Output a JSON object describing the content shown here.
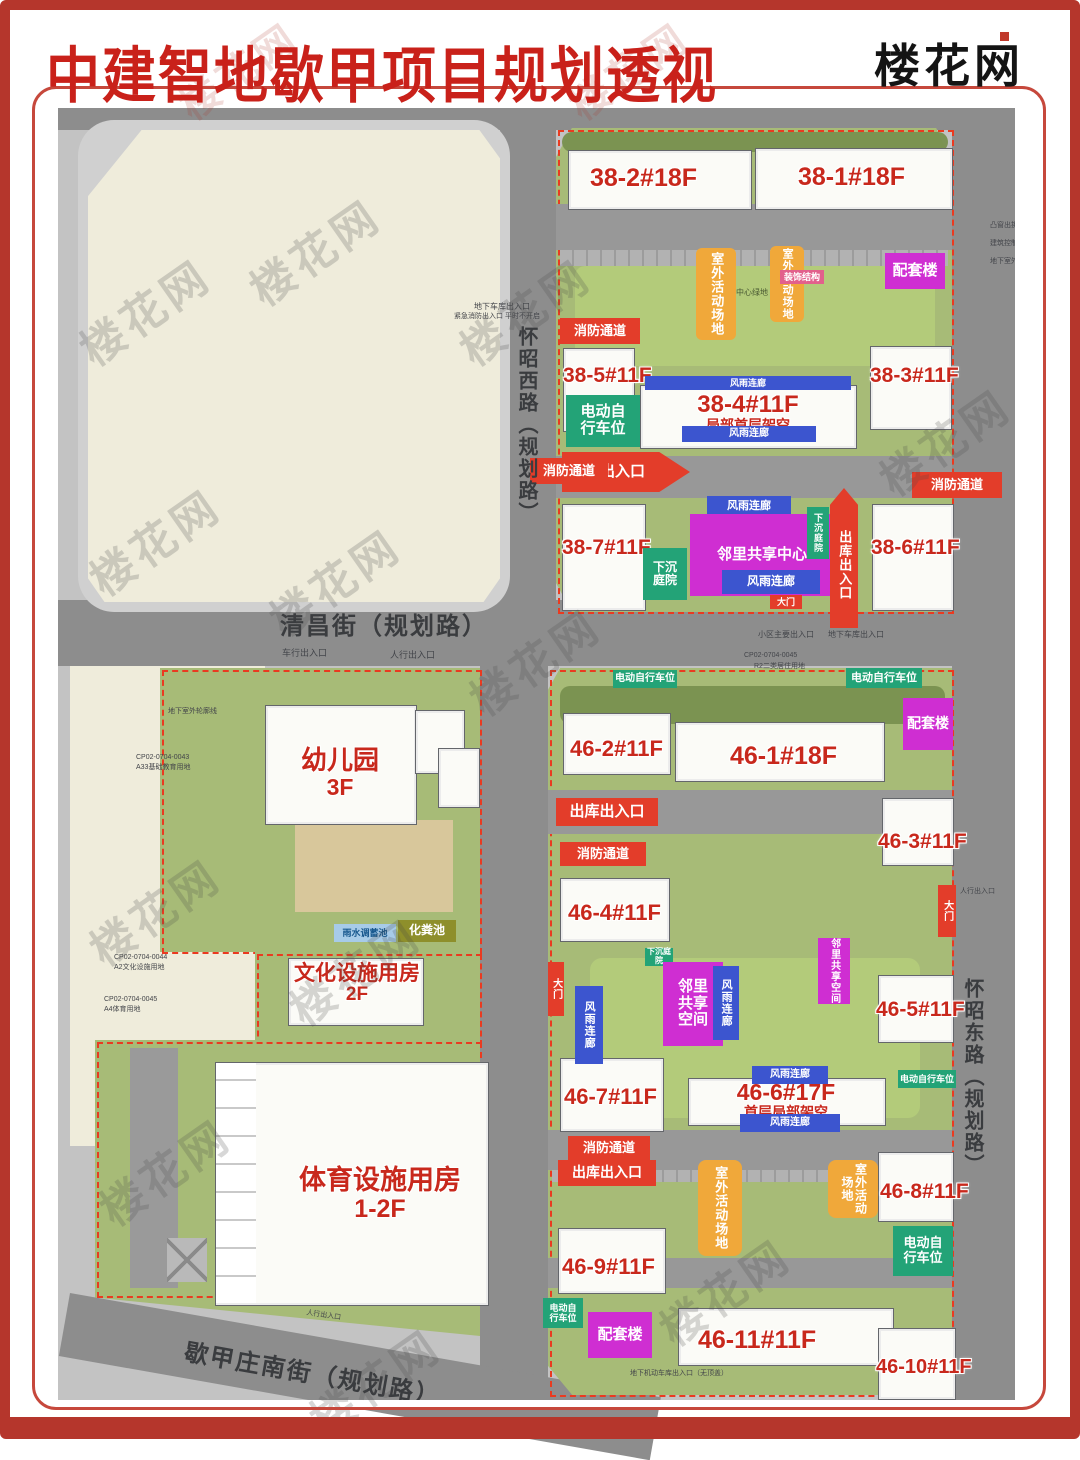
{
  "title": "中建智地歇甲项目规划透视",
  "logo": "楼花网",
  "watermark": "楼花网",
  "palette": {
    "accent_red": "#e33d2a",
    "badge_green": "#23a377",
    "badge_orange": "#f0a83a",
    "badge_magenta": "#cf2ed2",
    "badge_blue": "#3c55cf",
    "site_green": "#a7bb77",
    "road_gray": "#8d8d8d",
    "label_red": "#c8281c",
    "frame_red": "#b5362c"
  },
  "streets": {
    "north": "清昌街（规划路）",
    "west": "怀昭西路（规划路）",
    "east": "怀昭东路（规划路）",
    "south": "歇甲庄南街（规划路）"
  },
  "buildings": {
    "b382": "38-2#18F",
    "b381": "38-1#18F",
    "b385": "38-5#11F",
    "b384": "38-4#11F",
    "b384s": "局部首层架空",
    "b383": "38-3#11F",
    "b387": "38-7#11F",
    "b386": "38-6#11F",
    "b462": "46-2#11F",
    "b461": "46-1#18F",
    "b463": "46-3#11F",
    "b464": "46-4#11F",
    "b465": "46-5#11F",
    "b467": "46-7#11F",
    "b466": "46-6#17F",
    "b466s": "首层局部架空",
    "b468": "46-8#11F",
    "b469": "46-9#11F",
    "b4611": "46-11#11F",
    "b4610": "46-10#11F"
  },
  "facilities": {
    "kindergarten": "幼儿园",
    "kindergarten_floors": "3F",
    "culture": "文化设施用房",
    "culture_floors": "2F",
    "sports": "体育设施用房",
    "sports_floors": "1-2F"
  },
  "labels": {
    "ebike": "电动自行车位",
    "garage": "车库出入口",
    "fire": "消防通道",
    "depot": "出库出入口",
    "outdoor": "室外活动场地",
    "annex": "配套楼",
    "canopy": "风雨连廊",
    "sunken": "下沉庭院",
    "center": "邻里共享中心",
    "space": "邻里共享空间",
    "gate": "大门",
    "deco": "装饰结构",
    "septic": "化粪池",
    "rain": "雨水调蓄池"
  },
  "annotations": {
    "main_exit": "小区主要出入口",
    "garage_exit": "地下车库出入口",
    "ped_exit": "人行出入口",
    "veh_exit": "车行出入口",
    "center_green": "中心绿地",
    "r2": "R2二类居住用地",
    "cp43": "CP02-0704-0043",
    "cp43b": "A33基础教育用地",
    "cp44": "CP02-0704-0044",
    "cp44b": "A2文化设施用地",
    "cp45": "CP02-0704-0045",
    "cp45b": "A4体育用地",
    "emergency": "紧急消防出入口 平时不开启",
    "nodome": "地下机动车库出入口（无顶盖）",
    "bulge": "凸窗出挑",
    "ctrl": "建筑控制线",
    "outline": "地下室外轮廓线"
  }
}
